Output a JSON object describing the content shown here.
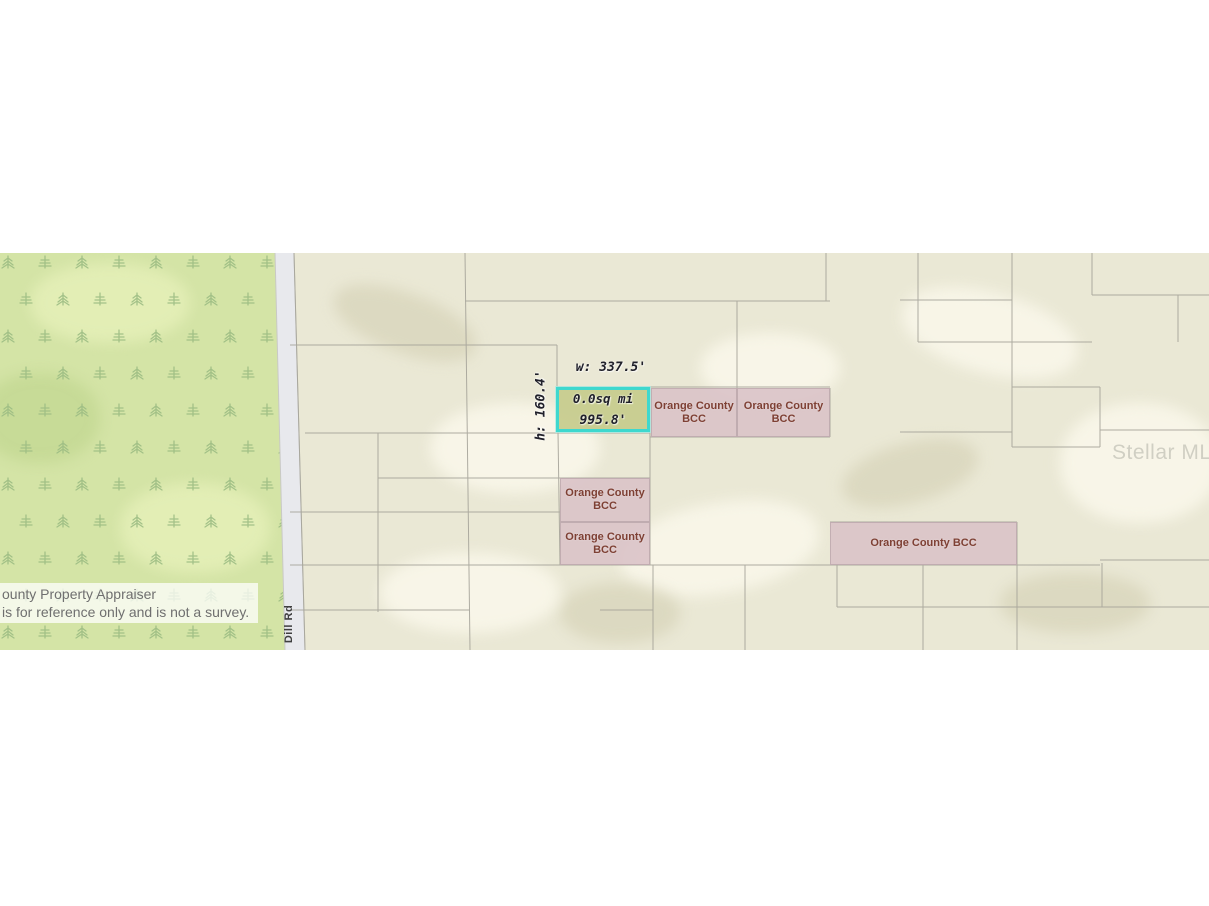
{
  "map": {
    "watermark": "Stellar MLS",
    "road_label": "Dill Rd",
    "disclaimer": {
      "line1": "ounty Property Appraiser",
      "line2": "is for reference only and is not a survey."
    },
    "selection": {
      "width_label": "w: 337.5'",
      "height_label": "h: 160.4'",
      "area_label": "0.0sq mi",
      "perimeter_label": "995.8'"
    },
    "highlighted_parcels": [
      {
        "owner": "Orange County BCC"
      },
      {
        "owner": "Orange County BCC"
      },
      {
        "owner": "Orange County BCC"
      },
      {
        "owner": "Orange County BCC"
      },
      {
        "owner": "Orange County BCC"
      }
    ],
    "colors": {
      "selection_border": "#3ED8CE",
      "selection_fill": "#C8CC8E",
      "highlight_fill": "#D9C1C7",
      "parcel_label_text": "#7E4034",
      "forest_fill": "#D4E4A6",
      "terrain_base": "#EAE8D5",
      "grid_line": "#A6A49A",
      "road_fill": "#E8E9ED"
    }
  }
}
